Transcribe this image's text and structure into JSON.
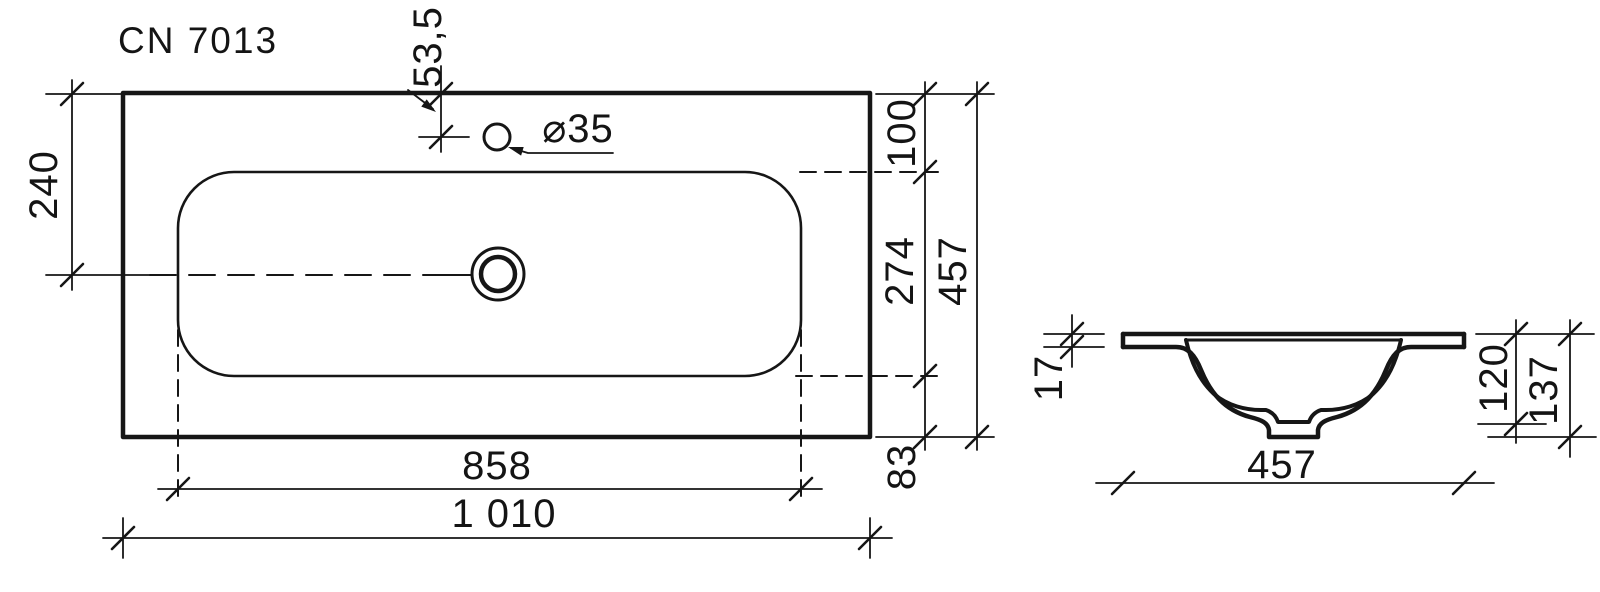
{
  "title": "CN 7013",
  "colors": {
    "line": "#161616",
    "background": "#ffffff"
  },
  "top_view": {
    "description": "washbasin top view",
    "dims": {
      "edge_to_centerline": "240",
      "faucet_hole_offset": "53,5",
      "faucet_hole_diameter": "⌀35",
      "front_edge_to_bowl": "100",
      "bowl_depth": "274",
      "overall_depth": "457",
      "bowl_to_back_edge": "83",
      "bowl_width": "858",
      "overall_width": "1 010"
    }
  },
  "section_view": {
    "description": "washbasin cross section",
    "dims": {
      "rim_thickness": "17",
      "bowl_height": "120",
      "overall_height": "137",
      "overall_depth": "457"
    }
  }
}
